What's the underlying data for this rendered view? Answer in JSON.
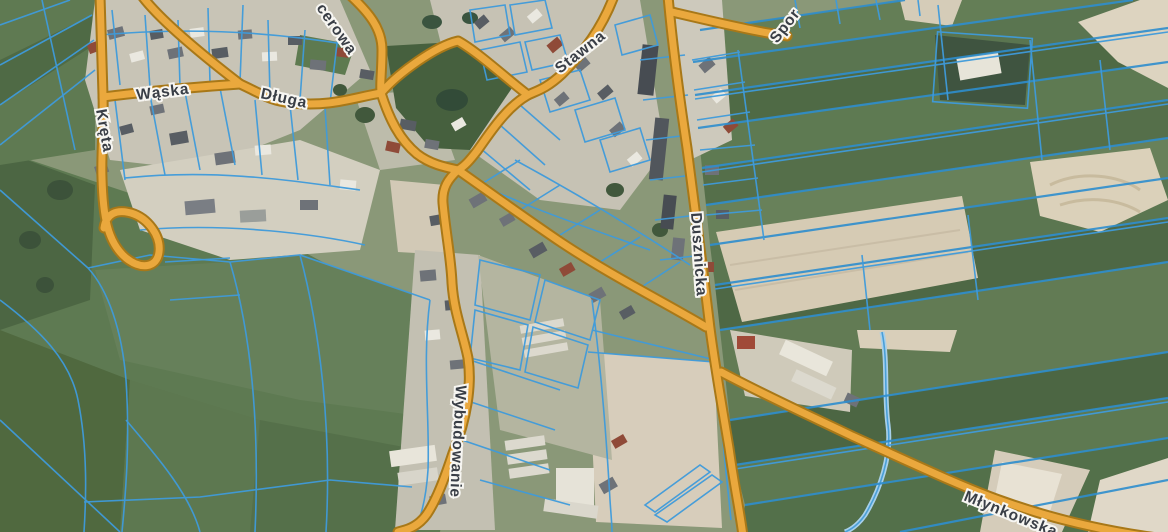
{
  "map": {
    "description": "Aerial satellite map with blue cadastral parcel boundaries and orange named streets (Polish village)",
    "street_labels": [
      {
        "text": "Kręta",
        "partial": false
      },
      {
        "text": "Wąska",
        "partial": false
      },
      {
        "text": "Długa",
        "partial": false
      },
      {
        "text": "cerowa",
        "partial": true
      },
      {
        "text": "Stawna",
        "partial": false
      },
      {
        "text": "Spor",
        "partial": true
      },
      {
        "text": "Dusznicka",
        "partial": false
      },
      {
        "text": "Wybudowanie",
        "partial": false
      },
      {
        "text": "Młynkowska",
        "partial": true
      }
    ],
    "colors": {
      "road_fill": "#eaa83d",
      "road_casing": "#a87818",
      "parcel_line": "#3f9bdb",
      "label_text": "#393e46",
      "label_halo": "#f7f6f2",
      "field_green_dark": "#49613f",
      "field_green": "#5b7650",
      "field_green_light": "#6d8660",
      "field_beige": "#d9cfba",
      "village_ground": "#c8c4b6"
    }
  }
}
